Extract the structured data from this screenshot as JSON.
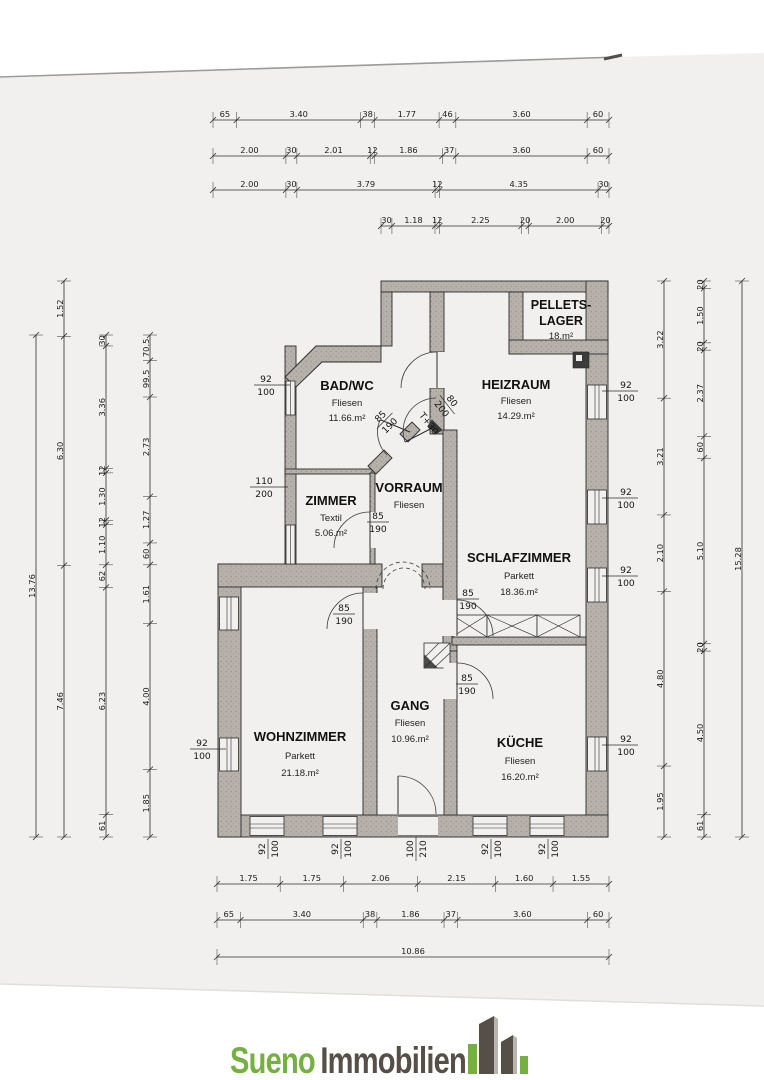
{
  "colors": {
    "paper": "#f1f0ee",
    "ink": "#2c2c2c",
    "wall_gray": "#b6b2ab",
    "logo_green": "#76b043",
    "logo_dark": "#564f47",
    "logo_light": "#b9b5ae"
  },
  "logo": {
    "word1": "Sueno",
    "word2": "Immobilien"
  },
  "rooms": {
    "pellets": {
      "name1": "PELLETS-",
      "name2": "LAGER",
      "area": "18.m²"
    },
    "heizraum": {
      "name": "HEIZRAUM",
      "floor": "Fliesen",
      "area": "14.29.m²"
    },
    "bad": {
      "name": "BAD/WC",
      "floor": "Fliesen",
      "area": "11.66.m²"
    },
    "zimmer": {
      "name": "ZIMMER",
      "floor": "Textil",
      "area": "5.06.m²"
    },
    "vorraum": {
      "name": "VORRAUM",
      "floor": "Fliesen"
    },
    "schlafzimmer": {
      "name": "SCHLAFZIMMER",
      "floor": "Parkett",
      "area": "18.36.m²"
    },
    "wohnzimmer": {
      "name": "WOHNZIMMER",
      "floor": "Parkett",
      "area": "21.18.m²"
    },
    "gang": {
      "name": "GANG",
      "floor": "Fliesen",
      "area": "10.96.m²"
    },
    "kueche": {
      "name": "KÜCHE",
      "floor": "Fliesen",
      "area": "16.20.m²"
    }
  },
  "openings": {
    "window": {
      "w": "92",
      "h": "100"
    },
    "door": {
      "w": "85",
      "h": "190"
    },
    "entry": {
      "w": "100",
      "h": "210"
    },
    "zimmer_window": {
      "w": "110",
      "h": "200"
    },
    "exterior_door": {
      "w": "80",
      "h": "200"
    },
    "threshold": "T+30"
  },
  "dims": {
    "top": [
      [
        [
          "65",
          65
        ],
        [
          "3.40",
          340
        ],
        [
          "38",
          38
        ],
        [
          "1.77",
          177
        ],
        [
          "46",
          46
        ],
        [
          "3.60",
          360
        ],
        [
          "60",
          60
        ]
      ],
      [
        [
          "2.00",
          200
        ],
        [
          "30",
          30
        ],
        [
          "2.01",
          201
        ],
        [
          "12",
          12
        ],
        [
          "1.86",
          186
        ],
        [
          "37",
          37
        ],
        [
          "3.60",
          360
        ],
        [
          "60",
          60
        ]
      ],
      [
        [
          "2.00",
          200
        ],
        [
          "30",
          30
        ],
        [
          "3.79",
          379
        ],
        [
          "12",
          12
        ],
        [
          "4.35",
          435
        ],
        [
          "30",
          30
        ]
      ],
      [
        [
          "30",
          30
        ],
        [
          "1.18",
          118
        ],
        [
          "12",
          12
        ],
        [
          "2.25",
          225
        ],
        [
          "20",
          20
        ],
        [
          "2.00",
          200
        ],
        [
          "20",
          20
        ]
      ]
    ],
    "bottom": [
      [
        [
          "1.75",
          175
        ],
        [
          "1.75",
          175
        ],
        [
          "2.06",
          206
        ],
        [
          "2.15",
          215
        ],
        [
          "1.60",
          160
        ],
        [
          "1.55",
          155
        ]
      ],
      [
        [
          "65",
          65
        ],
        [
          "3.40",
          340
        ],
        [
          "38",
          38
        ],
        [
          "1.86",
          186
        ],
        [
          "37",
          37
        ],
        [
          "3.60",
          360
        ],
        [
          "60",
          60
        ]
      ],
      [
        [
          "10.86",
          1086
        ]
      ]
    ],
    "left": [
      [
        [
          "13.76",
          1376
        ]
      ],
      [
        [
          "1.52",
          152
        ],
        [
          "6.30",
          630
        ],
        [
          "7.46",
          746
        ]
      ],
      [
        [
          "30",
          30
        ],
        [
          "3.36",
          336
        ],
        [
          "12",
          12
        ],
        [
          "1.30",
          130
        ],
        [
          "12",
          12
        ],
        [
          "1.10",
          110
        ],
        [
          "62",
          62
        ],
        [
          "6.23",
          623
        ],
        [
          "61",
          61
        ]
      ],
      [
        [
          "70.5",
          70.5
        ],
        [
          "99.5",
          99.5
        ],
        [
          "2.73",
          273
        ],
        [
          "1.27",
          127
        ],
        [
          "60",
          60
        ],
        [
          "1.61",
          161
        ],
        [
          "4.00",
          400
        ],
        [
          "1.85",
          185
        ]
      ]
    ],
    "right": [
      [
        [
          "3.22",
          322
        ],
        [
          "3.21",
          321
        ],
        [
          "2.10",
          210
        ],
        [
          "4.80",
          480
        ],
        [
          "1.95",
          195
        ]
      ],
      [
        [
          "20",
          20
        ],
        [
          "1.50",
          150
        ],
        [
          "20",
          20
        ],
        [
          "2.37",
          237
        ],
        [
          "60",
          60
        ],
        [
          "5.10",
          510
        ],
        [
          "20",
          20
        ],
        [
          "4.50",
          450
        ],
        [
          "61",
          61
        ]
      ],
      [
        [
          "15.28",
          1528
        ]
      ]
    ]
  }
}
